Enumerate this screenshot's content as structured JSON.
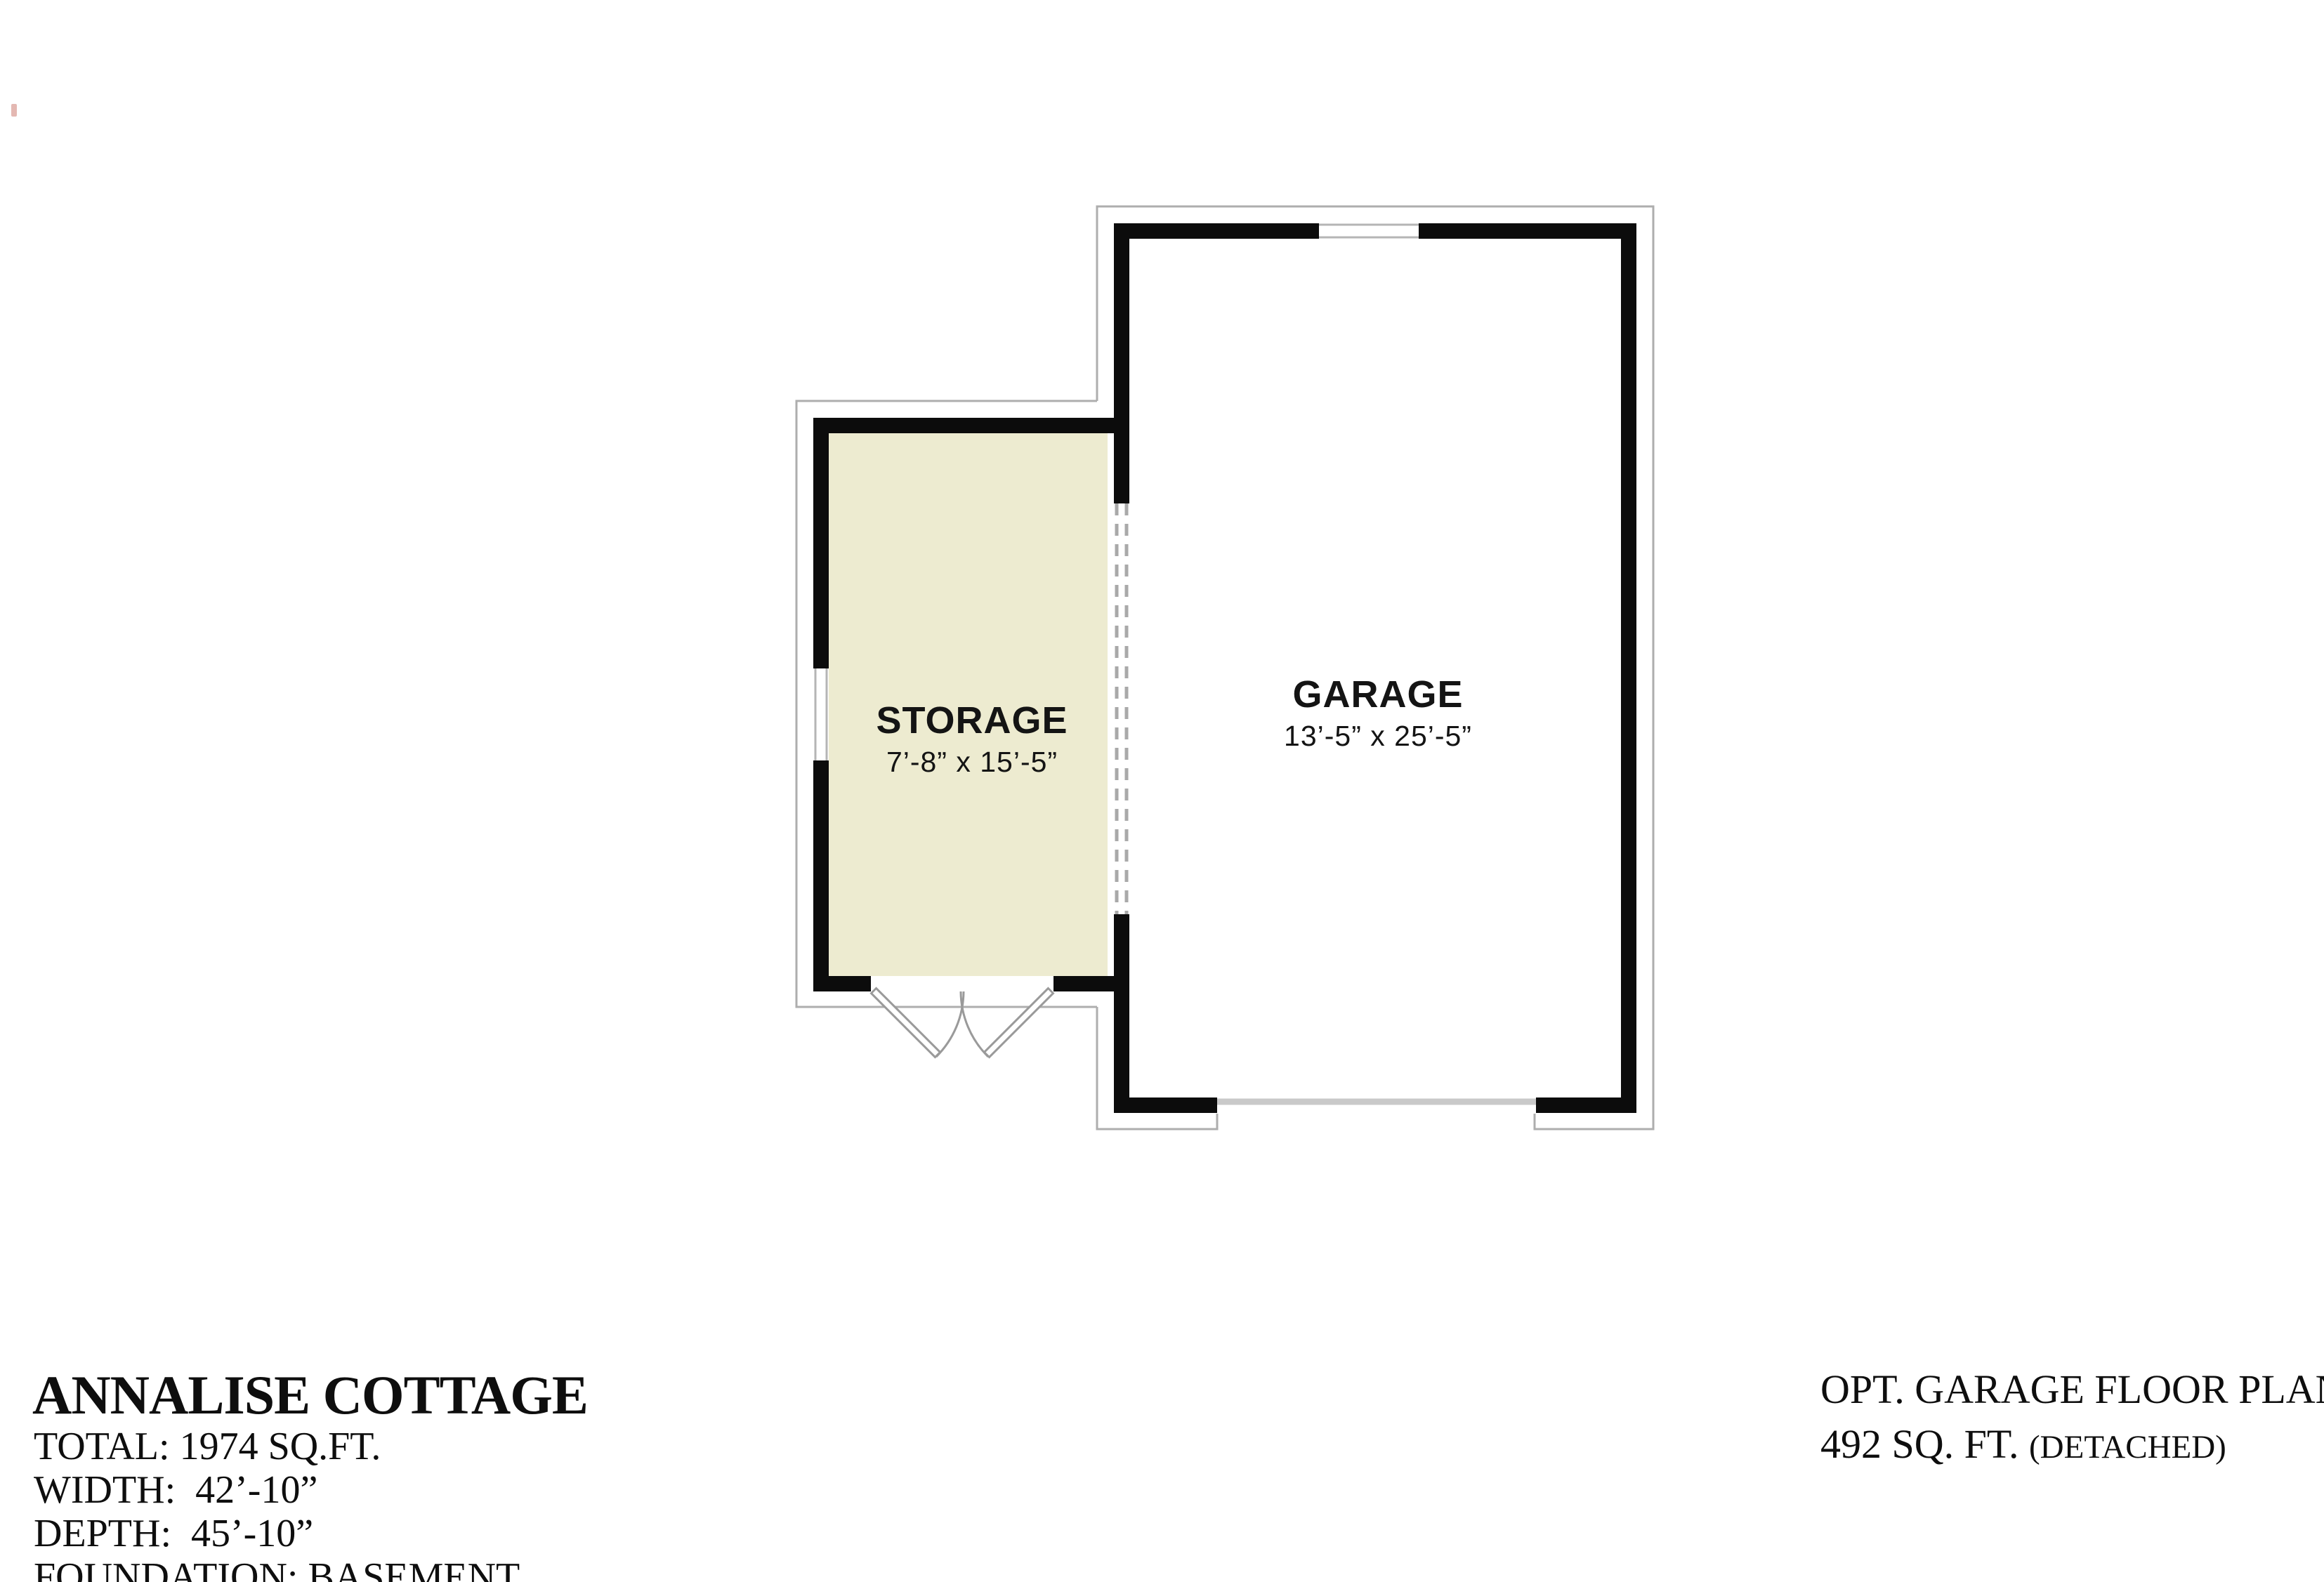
{
  "plan": {
    "rooms": [
      {
        "name": "STORAGE",
        "dimensions": "7’-8” x 15’-5”",
        "floor_color": "#edebd0"
      },
      {
        "name": "GARAGE",
        "dimensions": "13’-5” x 25’-5”",
        "floor_color": "#ffffff"
      }
    ],
    "features": [
      "double-swing-exterior-doors-storage",
      "open-dashed-wall-between-storage-and-garage",
      "window-storage-left-wall",
      "window-garage-top-wall",
      "garage-door-opening-bottom"
    ],
    "colors": {
      "wall": "#0c0c0c",
      "outline": "#aeaeae",
      "dashed_opening": "#a9a9a9",
      "door_swing": "#9a9a9a",
      "garage_door_line": "#c9c9c9"
    }
  },
  "title_block": {
    "plan_name": "ANNALISE COTTAGE",
    "lines": [
      "TOTAL: 1974 SQ.FT.",
      "WIDTH:  42’-10”",
      "DEPTH:  45’-10”",
      "FOUNDATION: BASEMENT"
    ]
  },
  "right_block": {
    "line1": "OPT. GARAGE FLOOR PLAN",
    "line2_main": "492 SQ. FT. ",
    "line2_suffix": "(DETACHED)"
  }
}
